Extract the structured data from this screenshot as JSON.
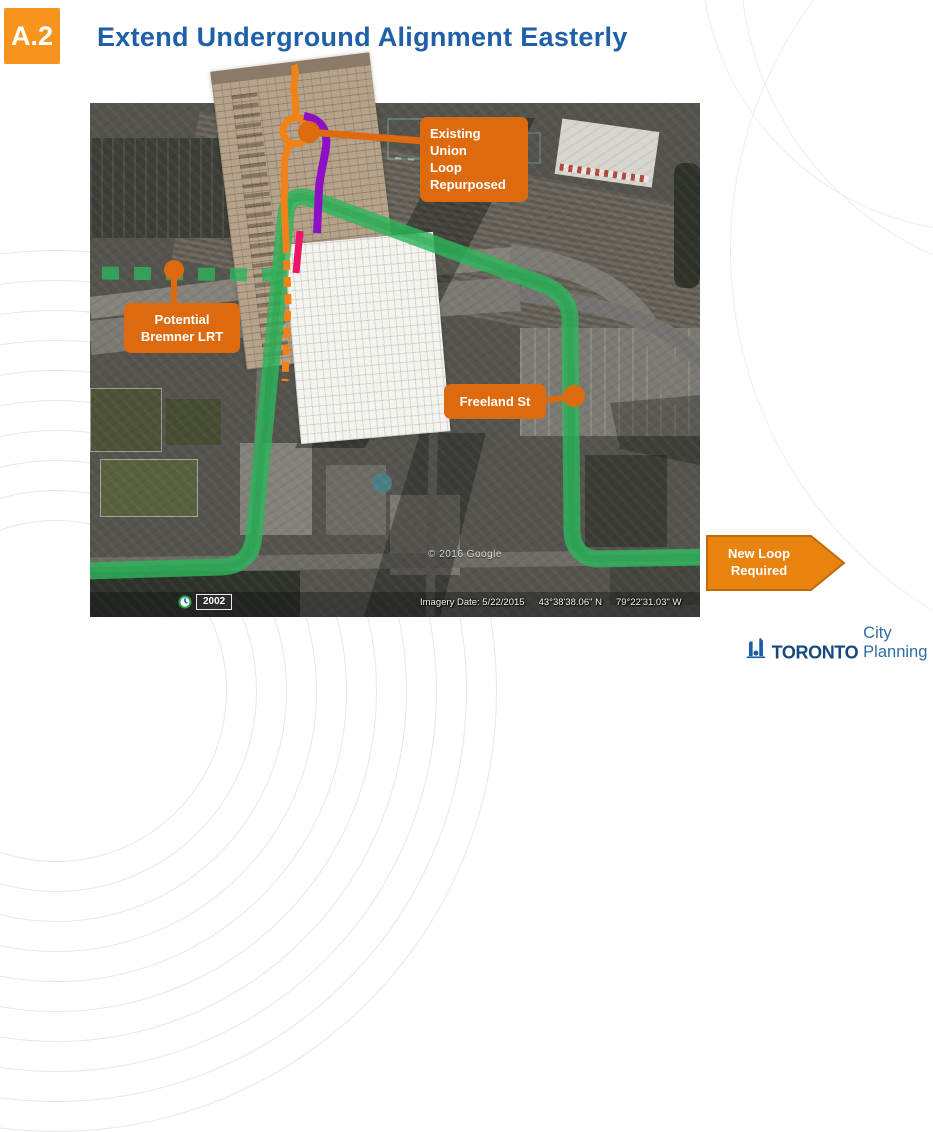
{
  "header": {
    "badge": "A.2",
    "title": "Extend Underground Alignment Easterly"
  },
  "map": {
    "callouts": {
      "union_loop": {
        "lines": [
          "Existing Union",
          "Loop",
          "Repurposed"
        ]
      },
      "bremner": {
        "lines": [
          "Potential",
          "Bremner LRT"
        ]
      },
      "freeland": {
        "label": "Freeland St"
      },
      "new_loop": {
        "lines": [
          "New Loop",
          "Required"
        ]
      }
    },
    "credits": {
      "copyright": "© 2016 Google",
      "imagery_date": "Imagery Date: 5/22/2015",
      "latitude": "43°38'38.06\" N",
      "longitude": "79°22'31.03\" W",
      "year_badge": "2002"
    }
  },
  "footer": {
    "logo_bold": "TORONTO",
    "logo_regular": "City Planning"
  },
  "icons": {
    "year_clock": "clock-icon",
    "logo_mark": "toronto-city-hall-icon"
  },
  "colors": {
    "callout_orange": "#DE6A10",
    "arrow_orange": "#E8830F",
    "badge_orange": "#F7941E",
    "title_blue": "#2060A8",
    "route_green": "#2EB45C",
    "route_purple": "#8E10C6",
    "route_magenta": "#EC1566",
    "route_orange": "#F08218",
    "logo_blue": "#17497F"
  }
}
